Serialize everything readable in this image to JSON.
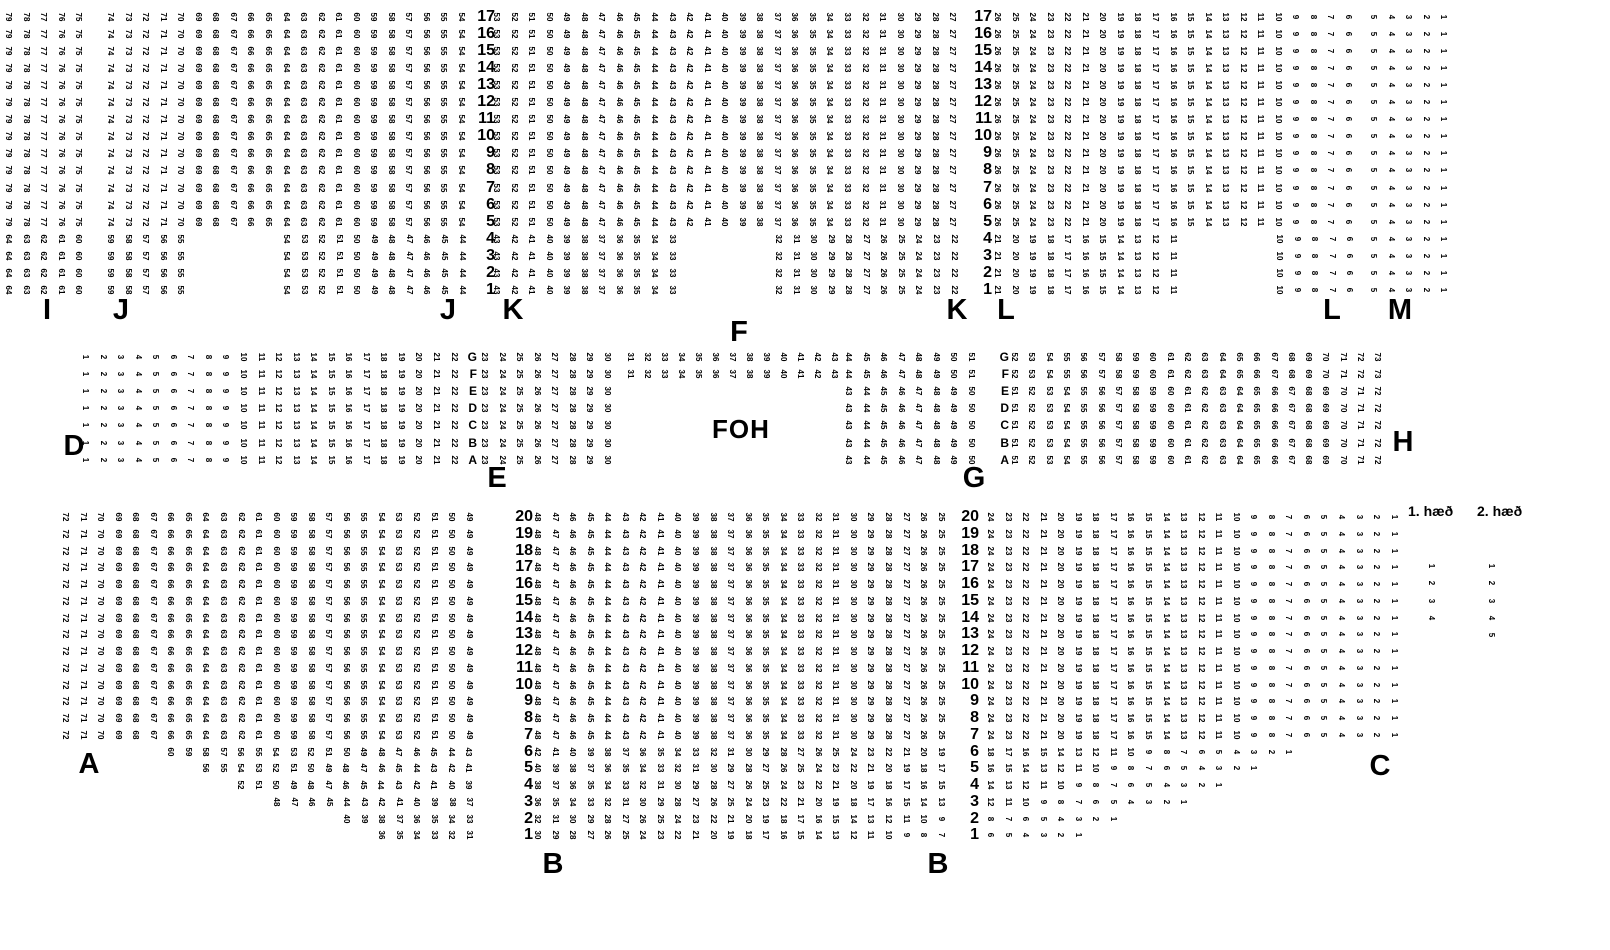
{
  "foh_label": "FOH",
  "legend": {
    "headers": [
      {
        "text": "1. hæð",
        "x": 1408,
        "y": 503
      },
      {
        "text": "2. hæð",
        "x": 1477,
        "y": 503
      }
    ],
    "columns": [
      {
        "x": 1431,
        "cy0": 566,
        "dy": 17.25,
        "numbers": [
          1,
          2,
          3,
          4
        ]
      },
      {
        "x": 1491,
        "cy0": 566,
        "dy": 17.25,
        "numbers": [
          1,
          2,
          3,
          4,
          5
        ]
      }
    ]
  },
  "section_labels": [
    {
      "text": "I",
      "x": 47,
      "y": 296
    },
    {
      "text": "J",
      "x": 121,
      "y": 296
    },
    {
      "text": "J",
      "x": 448,
      "y": 296
    },
    {
      "text": "K",
      "x": 513,
      "y": 296
    },
    {
      "text": "F",
      "x": 739,
      "y": 318
    },
    {
      "text": "K",
      "x": 957,
      "y": 296
    },
    {
      "text": "L",
      "x": 1006,
      "y": 296
    },
    {
      "text": "L",
      "x": 1332,
      "y": 296
    },
    {
      "text": "M",
      "x": 1400,
      "y": 296
    },
    {
      "text": "D",
      "x": 74,
      "y": 432
    },
    {
      "text": "E",
      "x": 497,
      "y": 464
    },
    {
      "text": "G",
      "x": 974,
      "y": 464
    },
    {
      "text": "H",
      "x": 1403,
      "y": 428
    },
    {
      "text": "A",
      "x": 89,
      "y": 750
    },
    {
      "text": "B",
      "x": 553,
      "y": 850
    },
    {
      "text": "B",
      "x": 938,
      "y": 850
    },
    {
      "text": "C",
      "x": 1380,
      "y": 752
    }
  ],
  "foh_pos": {
    "x": 712,
    "y": 416
  },
  "geometry": {
    "seat_dx": 17.55,
    "bands": [
      {
        "id": "top",
        "cy0": 17,
        "dy": 17.05,
        "rows": [
          "17",
          "16",
          "15",
          "14",
          "13",
          "12",
          "11",
          "10",
          "9",
          "8",
          "7",
          "6",
          "5",
          "4",
          "3",
          "2",
          "1"
        ]
      },
      {
        "id": "mid",
        "cy0": 357,
        "dy": 17.1,
        "rows": [
          "G",
          "F",
          "E",
          "D",
          "C",
          "B",
          "A"
        ]
      },
      {
        "id": "bottom",
        "cy0": 517,
        "dy": 16.75,
        "rows": [
          "20",
          "19",
          "18",
          "17",
          "16",
          "15",
          "14",
          "13",
          "12",
          "11",
          "10",
          "9",
          "8",
          "7",
          "6",
          "5",
          "4",
          "3",
          "2",
          "1"
        ]
      }
    ]
  },
  "row_number_columns": [
    {
      "band": "top",
      "right_x": 495,
      "rows": [
        "17",
        "1"
      ],
      "style": "rownum"
    },
    {
      "band": "top",
      "right_x": 992,
      "rows": [
        "17",
        "1"
      ],
      "style": "rownum"
    },
    {
      "band": "mid",
      "right_x": 477,
      "rows": [
        "G",
        "A"
      ],
      "style": "rowletter"
    },
    {
      "band": "mid",
      "right_x": 1009,
      "rows": [
        "G",
        "A"
      ],
      "style": "rowletter"
    },
    {
      "band": "bottom",
      "right_x": 533,
      "rows": [
        "20",
        "1"
      ],
      "style": "rownum"
    },
    {
      "band": "bottom",
      "right_x": 979,
      "rows": [
        "20",
        "1"
      ],
      "style": "rownum"
    }
  ],
  "blocks": [
    {
      "section": "I",
      "band": "top",
      "x": 8,
      "rows": [
        "17",
        "5"
      ],
      "seats": {
        "from": 79,
        "to": 75
      }
    },
    {
      "section": "I",
      "band": "top",
      "x": 8,
      "rows": [
        "4",
        "1"
      ],
      "seats": {
        "from": 64,
        "to": 60
      }
    },
    {
      "section": "J",
      "band": "top",
      "x": 110,
      "rows": [
        "17",
        "5"
      ],
      "seats": {
        "from": 74,
        "to": 54
      }
    },
    {
      "section": "J",
      "band": "top",
      "x": 110,
      "rows": [
        "4",
        "1"
      ],
      "seats": {
        "from": 59,
        "to": 55
      }
    },
    {
      "section": "J",
      "band": "top",
      "x": 286,
      "rows": [
        "4",
        "1"
      ],
      "seats": {
        "from": 54,
        "to": 44
      }
    },
    {
      "section": "K",
      "band": "top",
      "x": 496,
      "rows": [
        "17",
        "5"
      ],
      "seats": {
        "from": 53,
        "to": 27
      }
    },
    {
      "section": "K",
      "band": "top",
      "x": 496,
      "rows": [
        "4",
        "1"
      ],
      "seats": {
        "from": 43,
        "to": 33
      }
    },
    {
      "section": "K",
      "band": "top",
      "x": 778,
      "rows": [
        "4",
        "1"
      ],
      "seats": {
        "from": 32,
        "to": 22
      }
    },
    {
      "section": "L",
      "band": "top",
      "x": 997,
      "rows": [
        "17",
        "5"
      ],
      "seats": {
        "from": 26,
        "to": 6
      }
    },
    {
      "section": "L",
      "band": "top",
      "x": 997,
      "rows": [
        "4",
        "1"
      ],
      "seats": {
        "from": 21,
        "to": 11
      }
    },
    {
      "section": "L",
      "band": "top",
      "x": 1279,
      "rows": [
        "4",
        "1"
      ],
      "seats": {
        "from": 10,
        "to": 6
      }
    },
    {
      "section": "M",
      "band": "top",
      "x": 1373,
      "rows": [
        "17",
        "1"
      ],
      "seats": {
        "from": 5,
        "to": 1
      }
    },
    {
      "section": "D",
      "band": "mid",
      "x": 85,
      "rows": [
        "G",
        "A"
      ],
      "seats": {
        "from": 1,
        "to": 22
      }
    },
    {
      "section": "E",
      "band": "mid",
      "x": 484,
      "rows": [
        "G",
        "A"
      ],
      "seats": {
        "from": 23,
        "to": 30
      }
    },
    {
      "section": "F",
      "band": "mid",
      "x": 630,
      "rows": [
        "G",
        "F"
      ],
      "seats": {
        "from": 31,
        "to": 43
      },
      "dx": 17.0
    },
    {
      "section": "G",
      "band": "mid",
      "x": 848,
      "rows": [
        "G",
        "F"
      ],
      "seats": {
        "from": 44,
        "to": 51
      }
    },
    {
      "section": "G",
      "band": "mid",
      "x": 848,
      "rows": [
        "E",
        "A"
      ],
      "seats": {
        "from": 43,
        "to": 50
      }
    },
    {
      "section": "H",
      "band": "mid",
      "x": 1014,
      "rows": [
        "G",
        "F"
      ],
      "seats": {
        "from": 52,
        "to": 73
      },
      "dx": 17.3
    },
    {
      "section": "H",
      "band": "mid",
      "x": 1014,
      "rows": [
        "E",
        "A"
      ],
      "seats": {
        "from": 51,
        "to": 72
      },
      "dx": 17.3
    },
    {
      "section": "A",
      "band": "bottom",
      "x": 65,
      "rows": [
        "20",
        "7"
      ],
      "seats": {
        "from": 72,
        "to": 49
      }
    },
    {
      "section": "A",
      "band": "bottom",
      "x": 170,
      "rows": [
        "6",
        "6"
      ],
      "seats": {
        "from": 60,
        "to": 43
      }
    },
    {
      "section": "A",
      "band": "bottom",
      "x": 205,
      "rows": [
        "5",
        "5"
      ],
      "seats": {
        "from": 56,
        "to": 41
      }
    },
    {
      "section": "A",
      "band": "bottom",
      "x": 240,
      "rows": [
        "4",
        "4"
      ],
      "seats": {
        "from": 52,
        "to": 39
      }
    },
    {
      "section": "A",
      "band": "bottom",
      "x": 276,
      "rows": [
        "3",
        "3"
      ],
      "seats": {
        "from": 48,
        "to": 37
      }
    },
    {
      "section": "A",
      "band": "bottom",
      "x": 346,
      "rows": [
        "2",
        "2"
      ],
      "seats": {
        "from": 40,
        "to": 33
      }
    },
    {
      "section": "A",
      "band": "bottom",
      "x": 381,
      "rows": [
        "1",
        "1"
      ],
      "seats": {
        "from": 36,
        "to": 31
      }
    },
    {
      "section": "B",
      "band": "bottom",
      "x": 537,
      "rows": [
        "20",
        "7"
      ],
      "seats": {
        "from": 48,
        "to": 25
      }
    },
    {
      "section": "B",
      "band": "bottom",
      "x": 537,
      "rows": [
        "6",
        "6"
      ],
      "seats": {
        "from": 42,
        "to": 19
      }
    },
    {
      "section": "B",
      "band": "bottom",
      "x": 537,
      "rows": [
        "5",
        "5"
      ],
      "seats": {
        "from": 40,
        "to": 17
      }
    },
    {
      "section": "B",
      "band": "bottom",
      "x": 537,
      "rows": [
        "4",
        "4"
      ],
      "seats": {
        "from": 38,
        "to": 15
      }
    },
    {
      "section": "B",
      "band": "bottom",
      "x": 537,
      "rows": [
        "3",
        "3"
      ],
      "seats": {
        "from": 36,
        "to": 13
      }
    },
    {
      "section": "B",
      "band": "bottom",
      "x": 537,
      "rows": [
        "2",
        "2"
      ],
      "seats": {
        "from": 32,
        "to": 9
      }
    },
    {
      "section": "B",
      "band": "bottom",
      "x": 537,
      "rows": [
        "1",
        "1"
      ],
      "seats": {
        "from": 30,
        "to": 7
      }
    },
    {
      "section": "C",
      "band": "bottom",
      "x": 990,
      "rows": [
        "20",
        "7"
      ],
      "seats": {
        "from": 24,
        "to": 1
      }
    },
    {
      "section": "C",
      "band": "bottom",
      "x": 990,
      "rows": [
        "6",
        "6"
      ],
      "seats": {
        "from": 18,
        "to": 1
      }
    },
    {
      "section": "C",
      "band": "bottom",
      "x": 990,
      "rows": [
        "5",
        "5"
      ],
      "seats": {
        "from": 16,
        "to": 1
      }
    },
    {
      "section": "C",
      "band": "bottom",
      "x": 990,
      "rows": [
        "4",
        "4"
      ],
      "seats": {
        "from": 14,
        "to": 1
      }
    },
    {
      "section": "C",
      "band": "bottom",
      "x": 990,
      "rows": [
        "3",
        "3"
      ],
      "seats": {
        "from": 12,
        "to": 1
      }
    },
    {
      "section": "C",
      "band": "bottom",
      "x": 990,
      "rows": [
        "2",
        "2"
      ],
      "seats": {
        "from": 8,
        "to": 1
      }
    },
    {
      "section": "C",
      "band": "bottom",
      "x": 990,
      "rows": [
        "1",
        "1"
      ],
      "seats": {
        "from": 6,
        "to": 1
      }
    }
  ]
}
